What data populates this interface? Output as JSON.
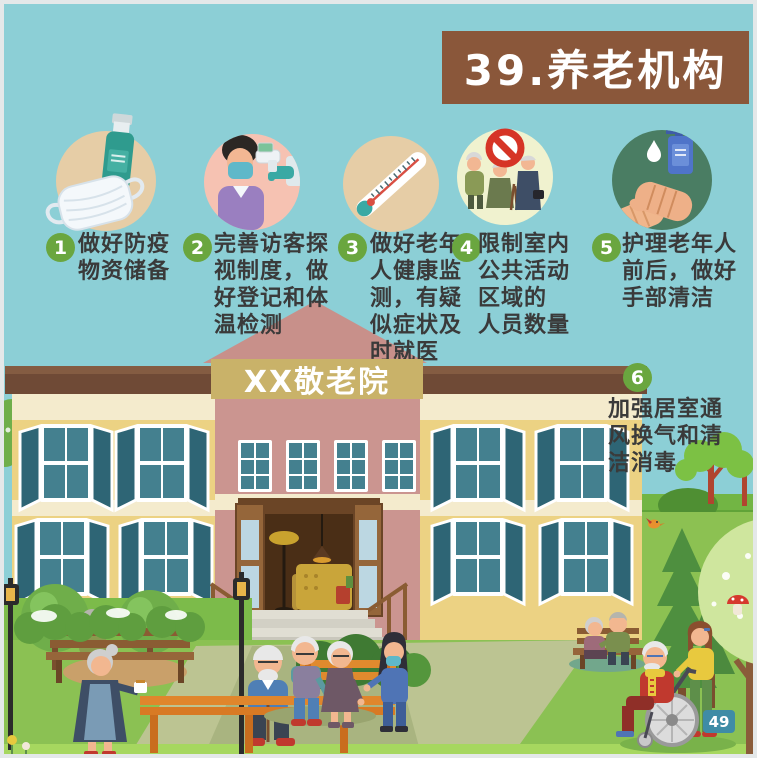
{
  "poster": {
    "title": "39.养老机构",
    "building_sign": "XX敬老院",
    "page_number": "49"
  },
  "steps": [
    {
      "number": "1",
      "label": "做好防疫\n物资储备",
      "icon": "mask-and-sanitizer-icon"
    },
    {
      "number": "2",
      "label": "完善访客探\n视制度，做\n好登记和体\n温检测",
      "icon": "visitor-temperature-check-icon"
    },
    {
      "number": "3",
      "label": "做好老年\n人健康监\n测，有疑\n似症状及\n时就医",
      "icon": "thermometer-icon"
    },
    {
      "number": "4",
      "label": "限制室内\n公共活动\n区域的\n人员数量",
      "icon": "no-gathering-icon"
    },
    {
      "number": "5",
      "label": "护理老年人\n前后，做好\n手部清洁",
      "icon": "hand-washing-icon"
    },
    {
      "number": "6",
      "label": "加强居室通\n风换气和清\n洁消毒",
      "icon": "ventilation-icon"
    }
  ],
  "colors": {
    "sky": "#8ccfd6",
    "title_box": "#8a573a",
    "number_badge": "#6aa63f",
    "page_badge": "#3f8ca6",
    "sign_board": "#c9b269",
    "text": "#3a3a3a"
  }
}
